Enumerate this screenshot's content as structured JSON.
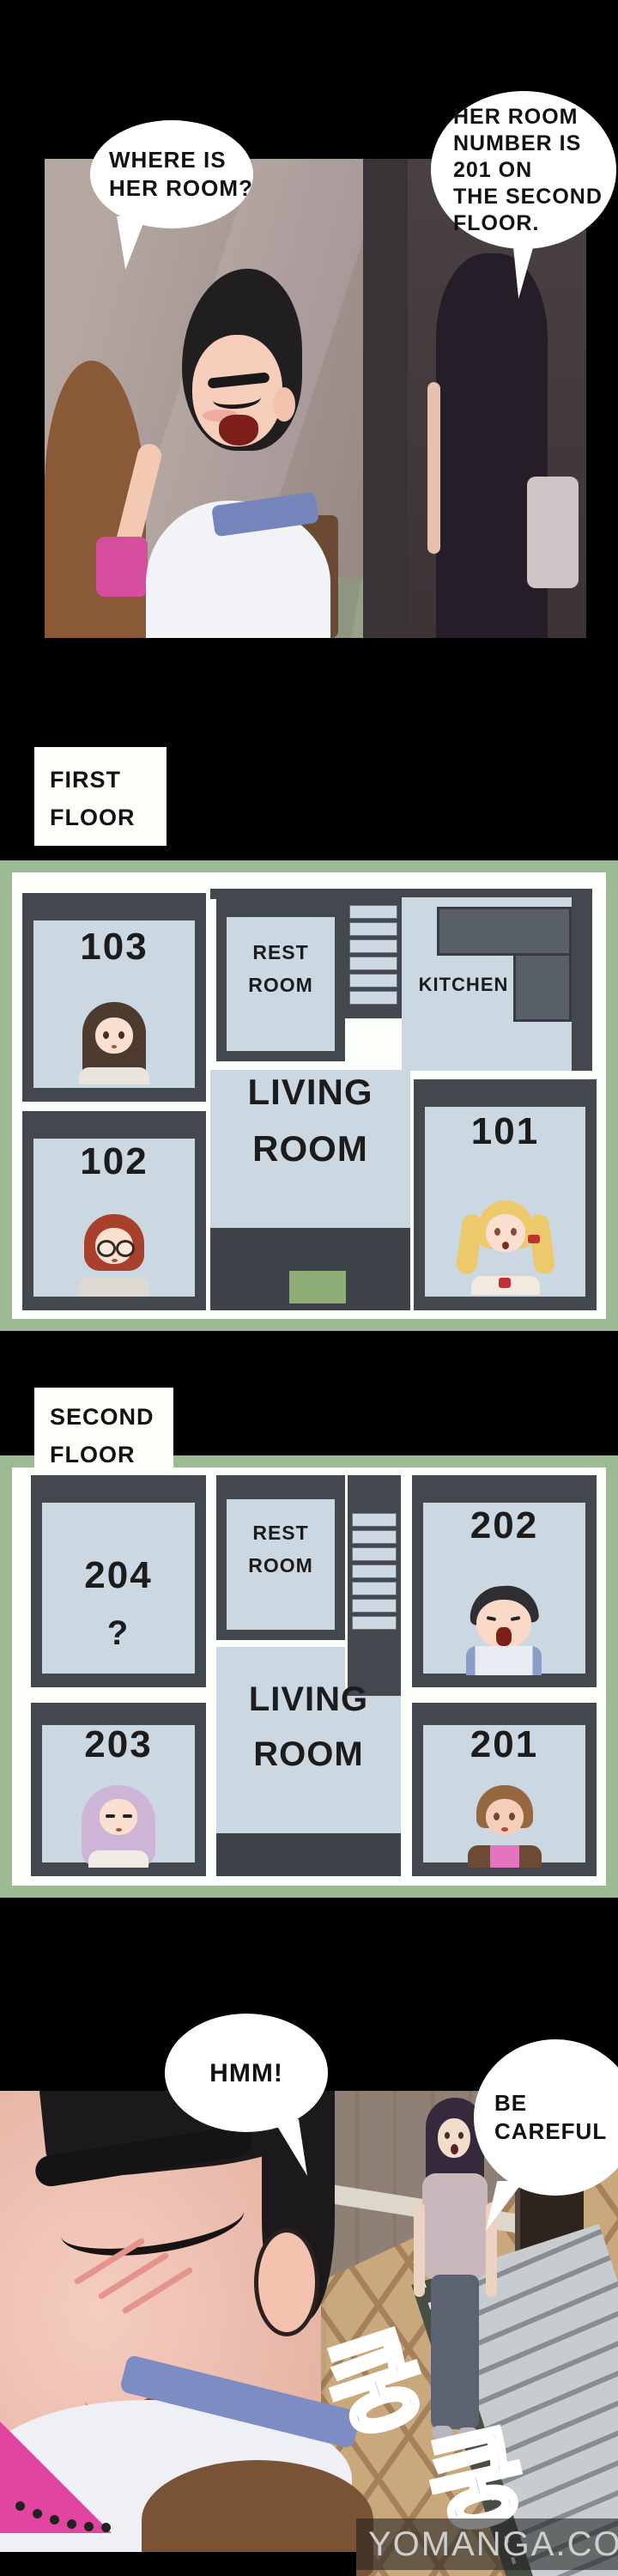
{
  "panel1": {
    "bubbles": [
      {
        "lines": [
          "WHERE IS",
          "HER ROOM?"
        ]
      },
      {
        "lines": [
          "HER ROOM",
          "NUMBER IS",
          "201 ON",
          "THE SECOND",
          "FLOOR."
        ]
      }
    ]
  },
  "labels": {
    "first_floor": {
      "lines": [
        "FIRST",
        "FLOOR"
      ]
    },
    "second_floor": {
      "lines": [
        "SECOND",
        "FLOOR"
      ]
    }
  },
  "floor1": {
    "room_103": "103",
    "room_102": "102",
    "room_101": "101",
    "rest_room": {
      "lines": [
        "REST",
        "ROOM"
      ]
    },
    "kitchen": "KITCHEN",
    "living": {
      "lines": [
        "LIVING",
        "ROOM"
      ]
    }
  },
  "floor2": {
    "room_204": "204",
    "room_204_mark": "?",
    "room_203": "203",
    "room_202": "202",
    "room_201": "201",
    "rest_room": {
      "lines": [
        "REST",
        "ROOM"
      ]
    },
    "living": {
      "lines": [
        "LIVING",
        "ROOM"
      ]
    }
  },
  "panel2": {
    "bubble_hmm": "HMM!",
    "bubble_careful": {
      "lines": [
        "BE",
        "CAREFUL"
      ]
    },
    "sfx": [
      "쿵",
      "쿵"
    ],
    "watermark": {
      "main": "YOMANGA.CO",
      "side": "YOMANGA"
    }
  },
  "colors": {
    "plan_border_green": "#9cba94",
    "plan_wall_dark": "#43474e",
    "plan_floor_blue": "#ccd8e1",
    "entrance_mat_green": "#8fae77",
    "bubble_white": "#ffffff",
    "background_black": "#000000"
  }
}
